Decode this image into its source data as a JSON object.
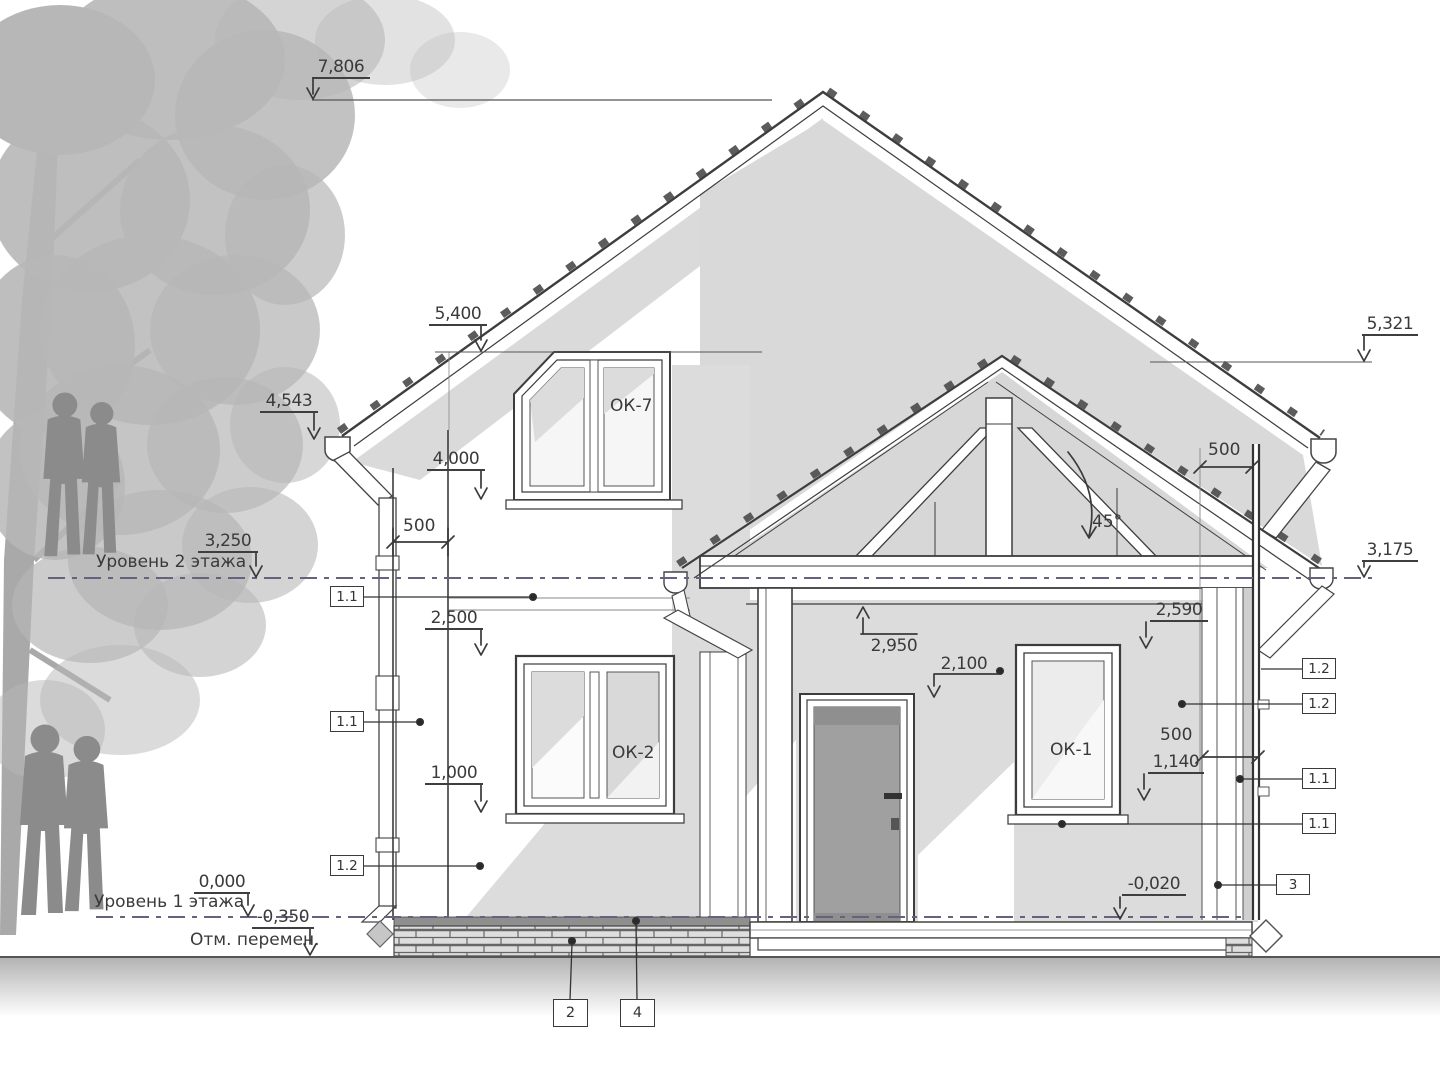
{
  "title": "Разрез дома / house section drawing",
  "levels": {
    "lv7806": "7,806",
    "lv5400": "5,400",
    "lv4543": "4,543",
    "lv4000": "4,000",
    "lv3250": "3,250",
    "lv2500": "2,500",
    "lv1000": "1,000",
    "lv0": "0,000",
    "lvm350": "-0,350",
    "lv5321": "5,321",
    "lv3175": "3,175",
    "lv2590": "2,590",
    "lv2950": "2,950",
    "lv2100": "2,100",
    "lv1140": "1,140",
    "lvm020": "-0,020"
  },
  "labels": {
    "floor2": "Уровень 2 этажа",
    "floor1": "Уровень 1 этажа",
    "ground": "Отм. перемен."
  },
  "dims": {
    "d500": "500",
    "angle": "45°"
  },
  "windows": {
    "ok7": "ОК-7",
    "ok2": "ОК-2",
    "ok1": "ОК-1"
  },
  "callouts": {
    "c11": "1.1",
    "c12": "1.2",
    "c2": "2",
    "c3": "3",
    "c4": "4"
  },
  "colors": {
    "line": "#3c3c3c",
    "level_line": "#63637c",
    "shadow": "#dadada",
    "door": "#a0a0a0",
    "silhouette": "#8b8b8b"
  }
}
